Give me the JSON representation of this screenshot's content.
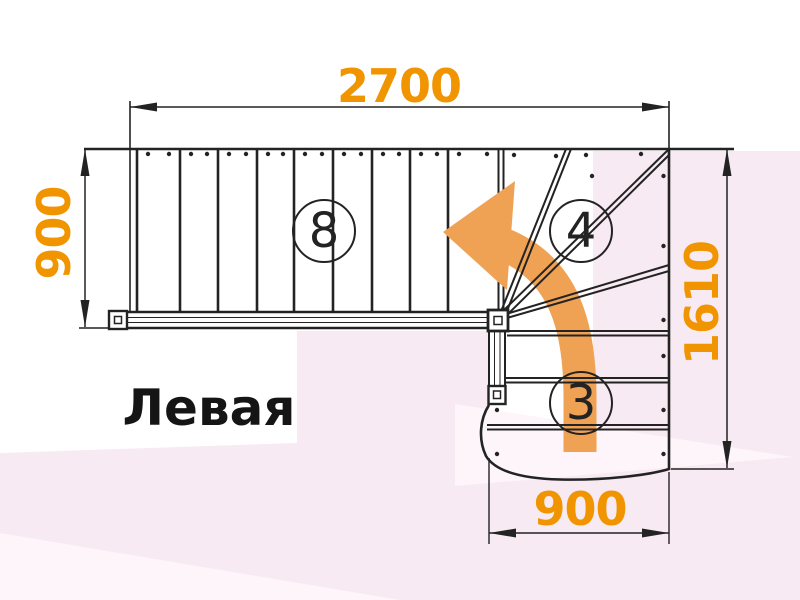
{
  "title": {
    "text": "Левая"
  },
  "dimensions": {
    "top": "2700",
    "left": "900",
    "right": "1610",
    "bottom": "900"
  },
  "step_labels": {
    "upper_flight": "8",
    "winder": "4",
    "lower_flight": "3"
  },
  "diagram": {
    "type": "staircase-floor-plan",
    "direction_arrow": "curved-arrow-up-then-left",
    "upper_flight_steps": 8,
    "winder_steps": 4,
    "lower_flight_steps": 3
  },
  "colors": {
    "paper": "#ffffff",
    "ink": "#232323",
    "dim_text": "#f09400",
    "arrow": "#f0a254",
    "tint": "#f8eaf2",
    "tint_light": "#fdf5f9",
    "title": "#151515"
  }
}
